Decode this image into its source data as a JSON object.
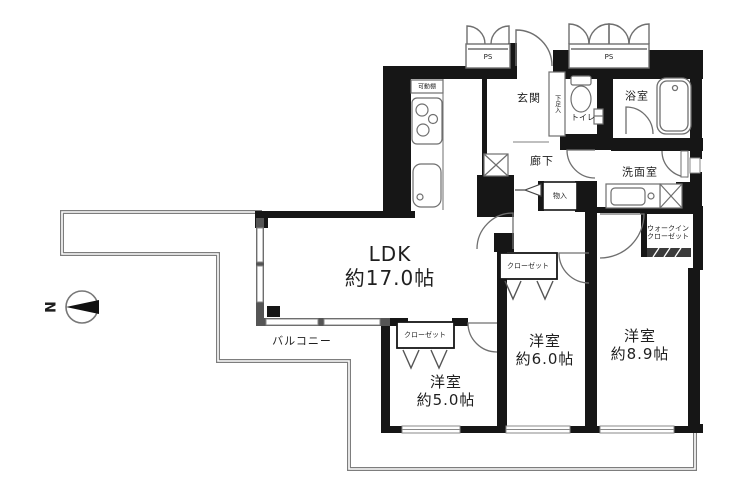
{
  "north": {
    "label": "N"
  },
  "outdoor": {
    "balcony": "バルコニー"
  },
  "service": {
    "ps1": "PS",
    "ps2": "PS"
  },
  "entrance": {
    "label": "玄関",
    "shoe_cupboard": "下足入"
  },
  "sanitary": {
    "toilet": "トイレ",
    "bath": "浴室",
    "washroom": "洗面室"
  },
  "hallway": {
    "label": "廊下",
    "storage": "物入"
  },
  "kitchen": {
    "shelf": "可動棚"
  },
  "ldk": {
    "name": "LDK",
    "size": "約17.0帖"
  },
  "bedroom_5": {
    "name": "洋室",
    "size": "約5.0帖",
    "closet": "クローゼット"
  },
  "bedroom_6": {
    "name": "洋室",
    "size": "約6.0帖",
    "closet": "クローゼット"
  },
  "bedroom_8": {
    "name": "洋室",
    "size": "約8.9帖",
    "wic_line1": "ウォークイン",
    "wic_line2": "クローゼット"
  }
}
